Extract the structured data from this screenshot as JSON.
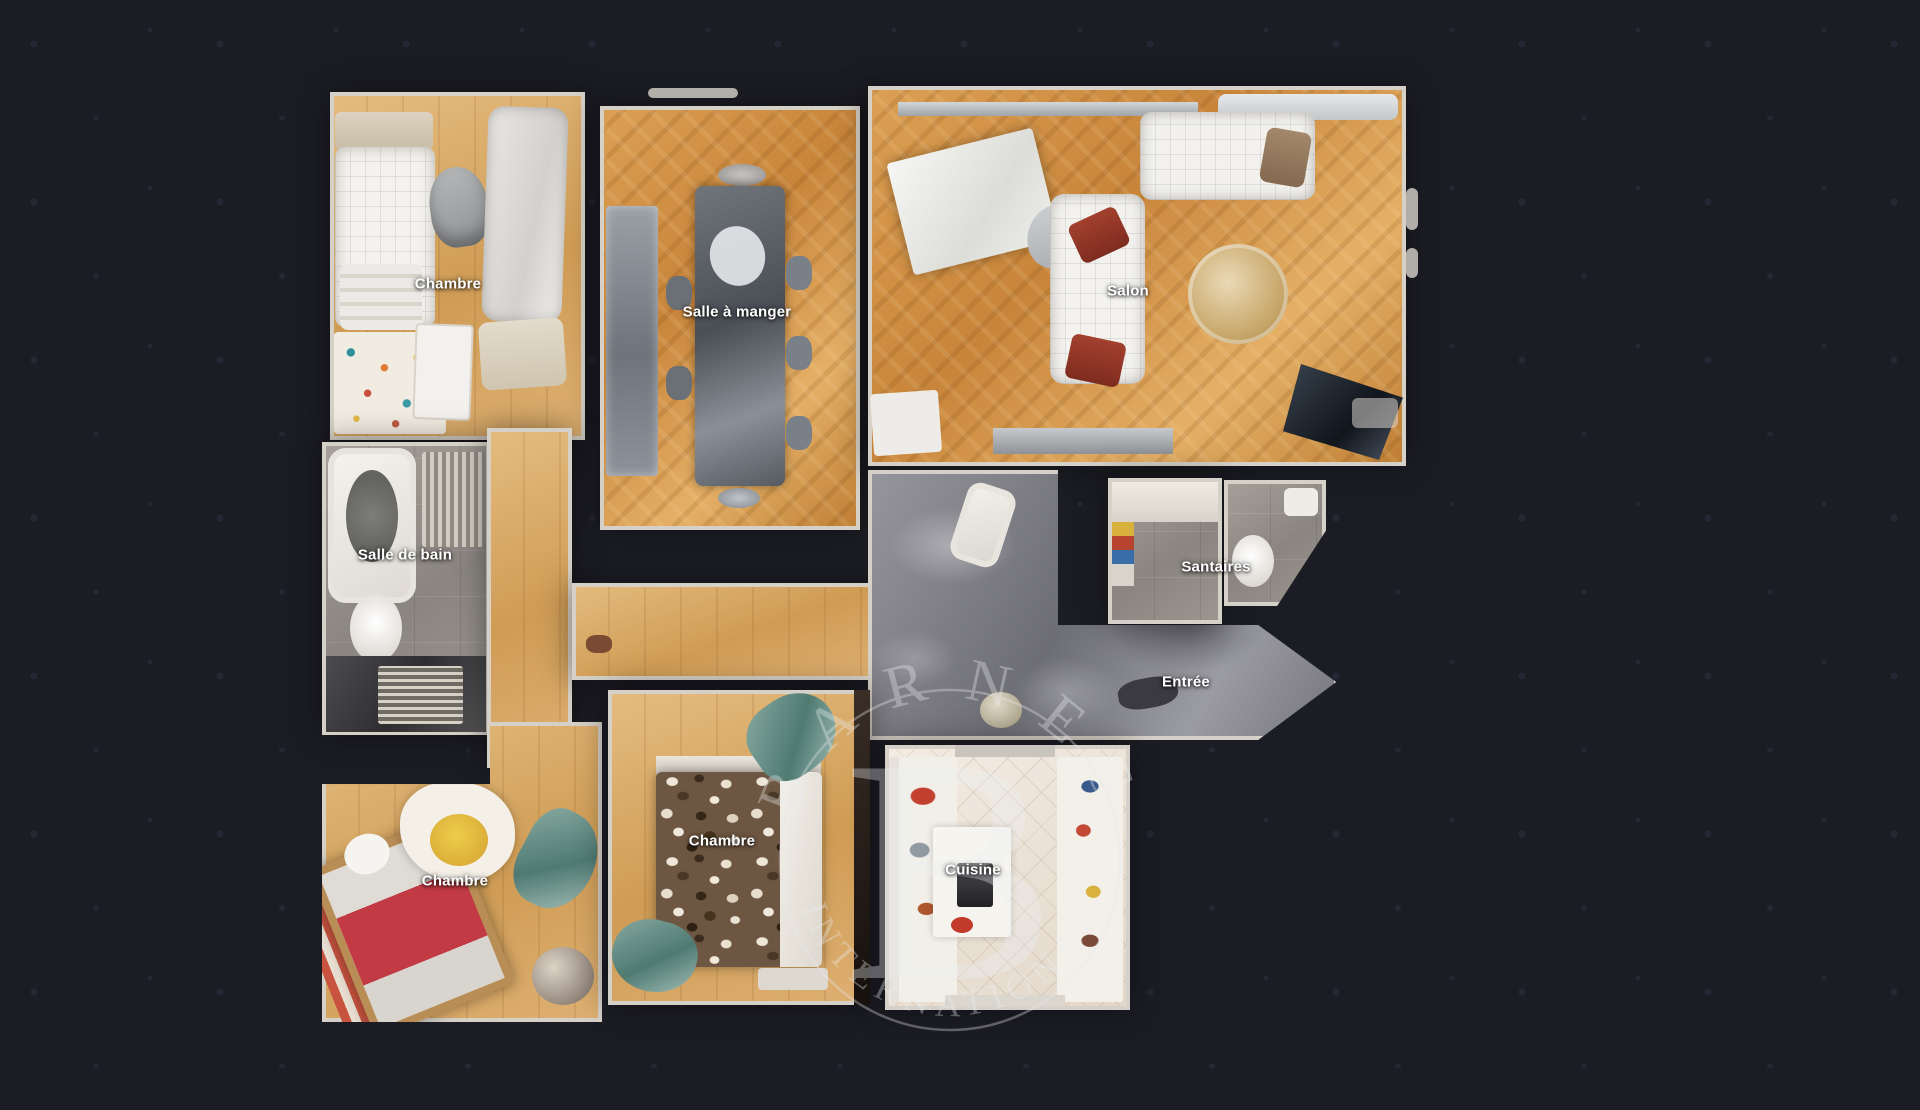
{
  "palette": {
    "bg": "#1c1c24",
    "dot": "#262634",
    "wall": "#d6d1c8",
    "parquet": "#c98c40",
    "wood_light": "#d9ab6a",
    "tile_grey": "#98938c",
    "marble_grey": "#85858a",
    "kitchen_tile": "#ece4d9",
    "label_color": "#ffffff",
    "watermark_color": "#eceff2"
  },
  "watermark": {
    "arc_top": "BARNES",
    "monogram": "B",
    "arc_bottom": "INTERNATIONAL"
  },
  "rooms": [
    {
      "id": "chambre-nord",
      "label": "Chambre",
      "floor": "wood"
    },
    {
      "id": "salle-a-manger",
      "label": "Salle à manger",
      "floor": "parquet"
    },
    {
      "id": "salon",
      "label": "Salon",
      "floor": "parquet"
    },
    {
      "id": "salle-de-bain",
      "label": "Salle de bain",
      "floor": "grey-tile"
    },
    {
      "id": "santaires",
      "label": "Santaires",
      "floor": "grey-tile"
    },
    {
      "id": "entree",
      "label": "Entrée",
      "floor": "grey-marble"
    },
    {
      "id": "chambre-sud-ouest",
      "label": "Chambre",
      "floor": "wood"
    },
    {
      "id": "chambre-sud",
      "label": "Chambre",
      "floor": "wood"
    },
    {
      "id": "cuisine",
      "label": "Cuisine",
      "floor": "white-tile"
    }
  ]
}
